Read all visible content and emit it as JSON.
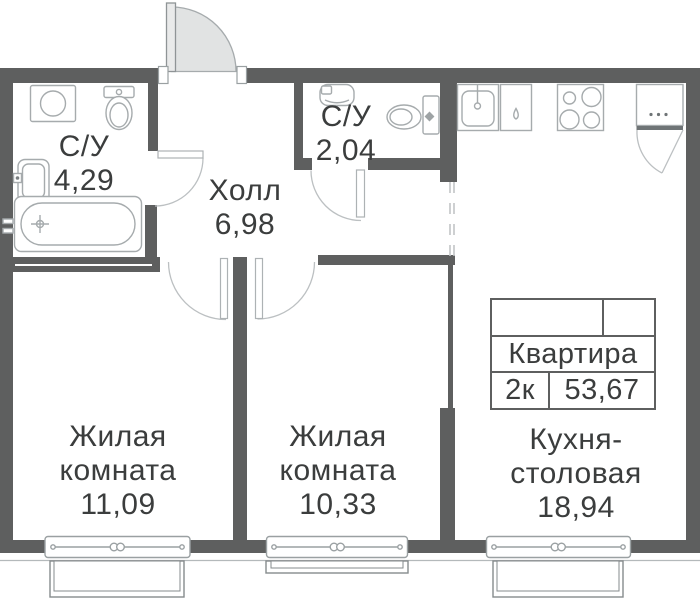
{
  "rooms": {
    "bathroom_main": {
      "label": "С/У",
      "area": "4,29"
    },
    "bathroom_small": {
      "label": "С/У",
      "area": "2,04"
    },
    "hall": {
      "label": "Холл",
      "area": "6,98"
    },
    "living1": {
      "line1": "Жилая",
      "line2": "комната",
      "area": "11,09"
    },
    "living2": {
      "line1": "Жилая",
      "line2": "комната",
      "area": "10,33"
    },
    "kitchen": {
      "line1": "Кухня-",
      "line2": "столовая",
      "area": "18,94"
    }
  },
  "info_table": {
    "name": "Квартира",
    "type": "2к",
    "total_area": "53,67"
  },
  "fixtures": [
    "washing-machine",
    "toilet",
    "sink",
    "bathtub",
    "wash-basin",
    "toilet",
    "kitchen-sink",
    "dishwasher",
    "stove",
    "refrigerator"
  ],
  "colors": {
    "wall": "#5e5f5f",
    "fixture_stroke": "#a6abad",
    "door_arc_stroke": "#bcc0c2",
    "entry_door_fill": "#e1e3e3",
    "text": "#3b3d3d"
  }
}
